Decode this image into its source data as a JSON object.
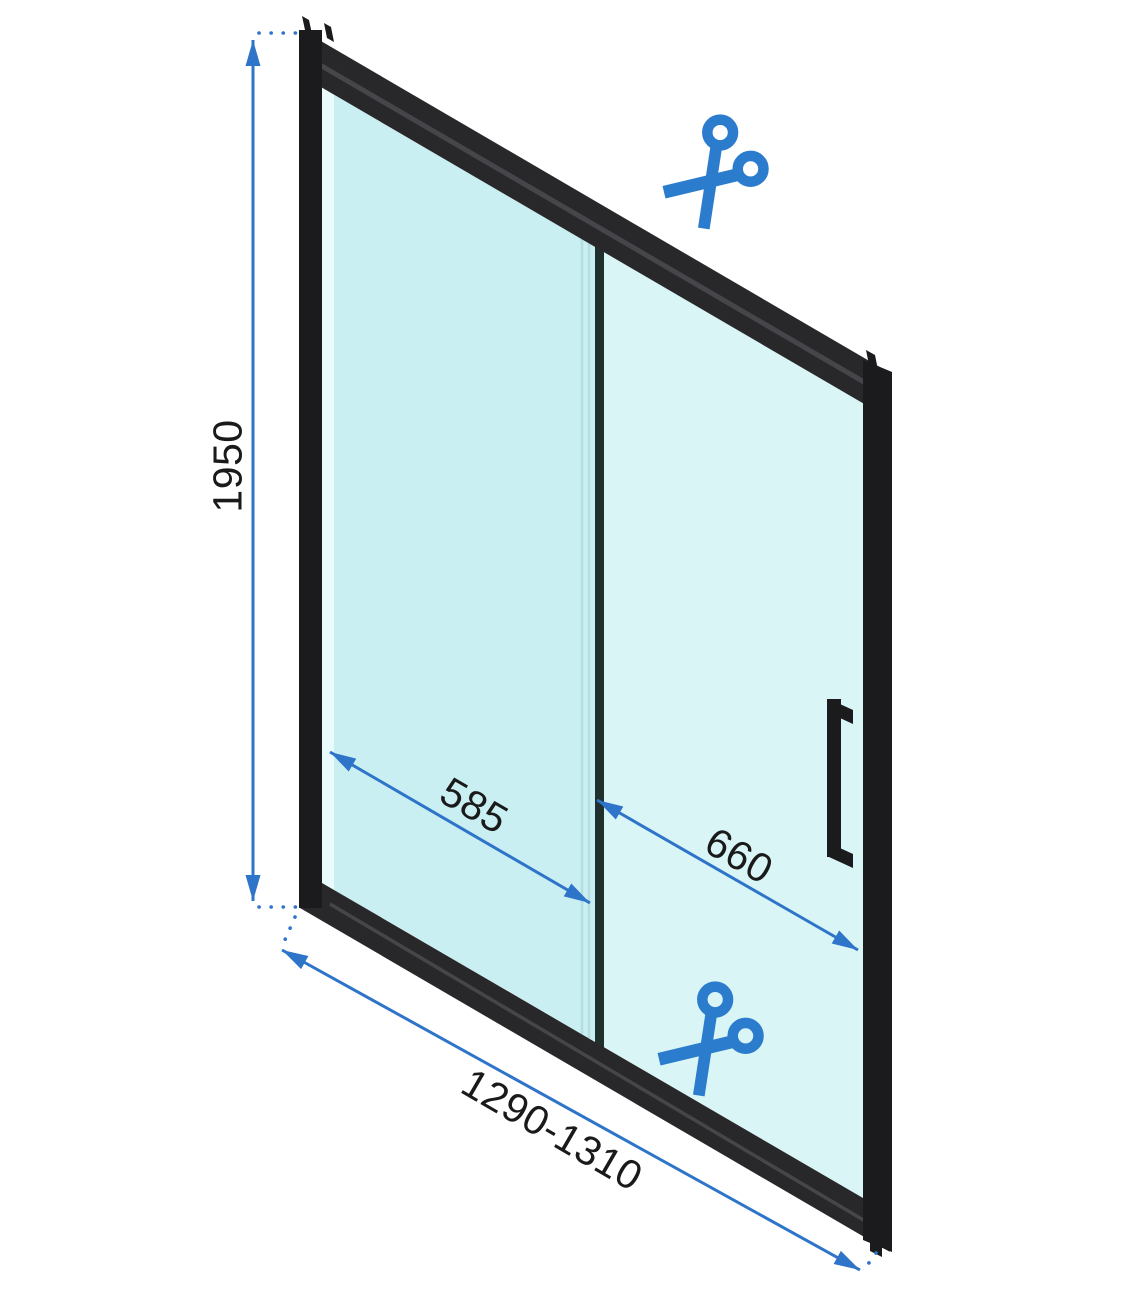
{
  "labels": {
    "height": "1950",
    "fixed_panel_width": "585",
    "sliding_panel_width": "660",
    "total_width": "1290-1310"
  },
  "icons": {
    "scissors": "✂"
  },
  "colors": {
    "background": "#ffffff",
    "dimension_blue": "#2e74c9",
    "scissors_blue": "#2b7ccd",
    "frame_black": "#28282b",
    "frame_dark": "#1b1b1e",
    "frame_bevel": "#46464a",
    "glass_left": "#c9eff2",
    "glass_right": "#d9f5f6",
    "glass_edge": "#e9fbfc",
    "glass_line": "#b5dee1",
    "divider_dark": "#20302d",
    "label_text": "#1a1a1a"
  }
}
